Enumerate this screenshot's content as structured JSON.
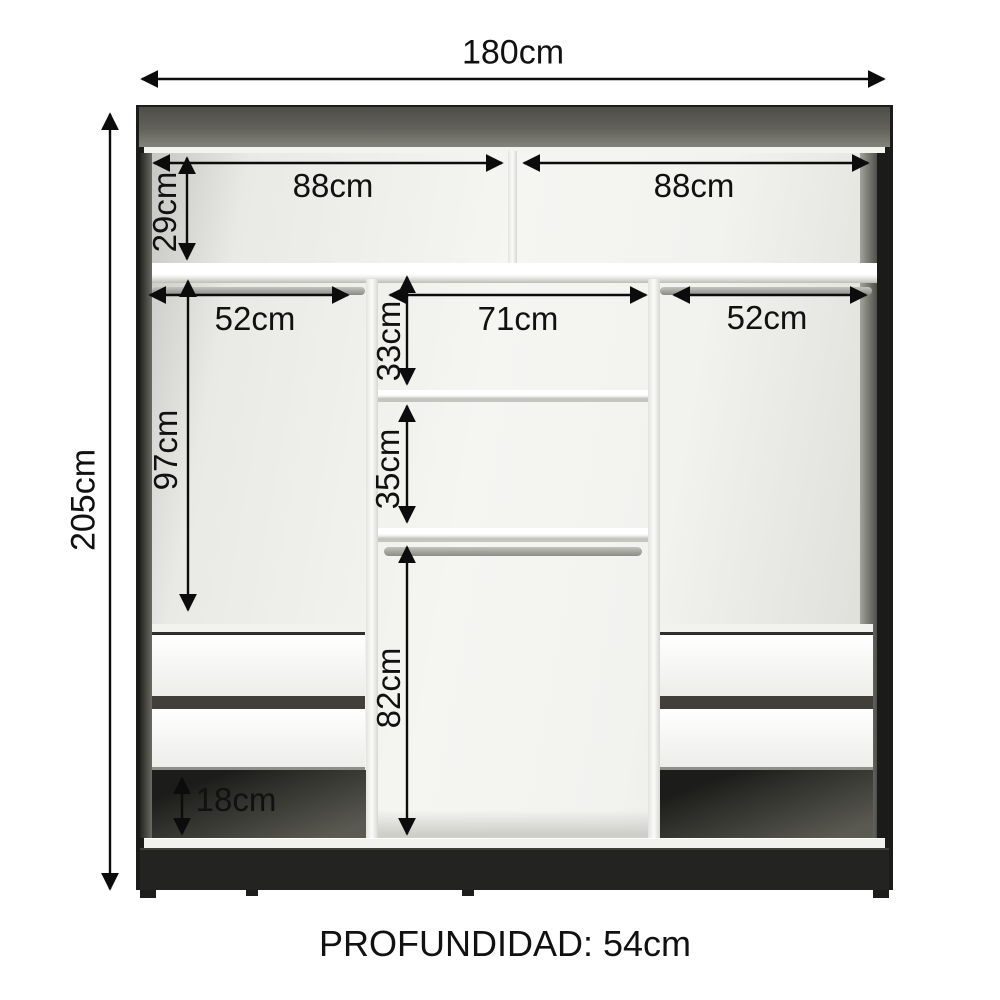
{
  "diagram": {
    "depth_label": "PROFUNDIDAD: 54cm",
    "dims": {
      "total_width": "180cm",
      "total_height": "205cm",
      "top_left_width": "88cm",
      "top_right_width": "88cm",
      "top_section_height": "29cm",
      "left_rod_width": "52cm",
      "center_width": "71cm",
      "right_rod_width": "52cm",
      "center_upper_height": "33cm",
      "left_hanging_height": "97cm",
      "center_middle_height": "35cm",
      "center_lower_height": "82cm",
      "plinth_clearance_height": "18cm"
    },
    "colors": {
      "arrow": "#0c0c0c",
      "cabinet_dark": "#232321",
      "interior_light": "#f2f2ef"
    }
  }
}
